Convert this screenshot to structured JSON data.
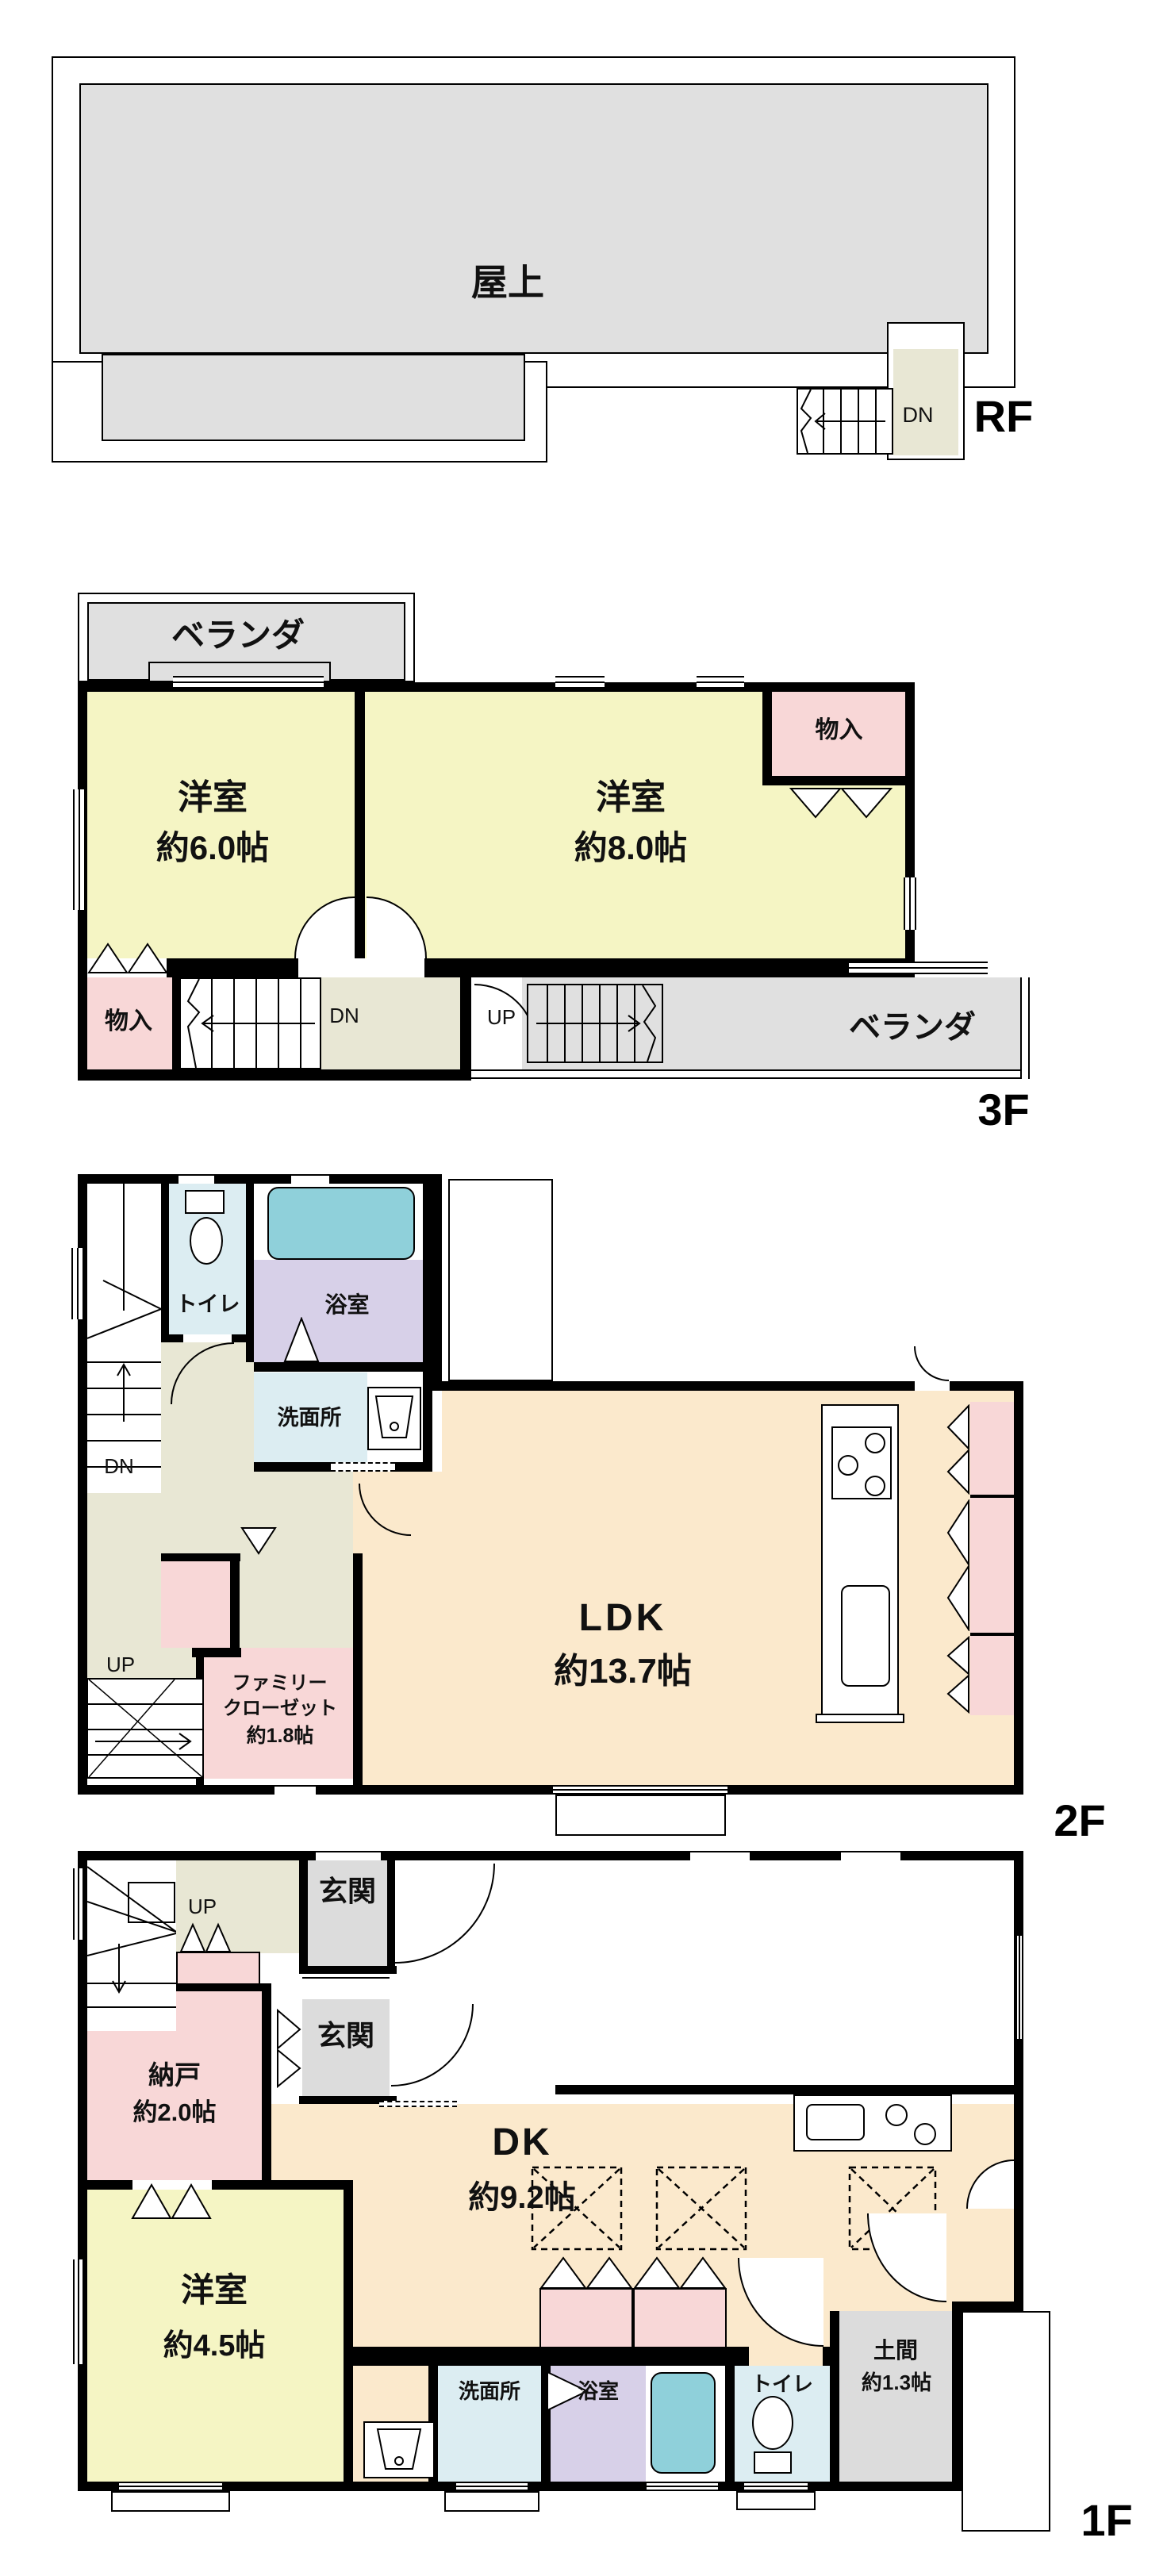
{
  "title": "間取り図",
  "colors": {
    "room_yellow": "#f5f5c4",
    "closet_pink": "#f8d7d7",
    "ldk_cream": "#fbe9cc",
    "wet_blue": "#dcedf2",
    "bath_purple": "#d7d0e8",
    "tub_teal": "#8fd0da",
    "veranda_gray": "#e0e0e0",
    "hall_beige": "#e8e7d4",
    "wall_black": "#000000"
  },
  "floors": {
    "rf": {
      "label": "RF",
      "rooftop": "屋上",
      "dn": "DN"
    },
    "f3": {
      "label": "3F",
      "veranda_top": "ベランダ",
      "veranda_bottom": "ベランダ",
      "room_a_name": "洋室",
      "room_a_size": "約6.0帖",
      "room_b_name": "洋室",
      "room_b_size": "約8.0帖",
      "closet_top": "物入",
      "closet_bottom": "物入",
      "dn": "DN",
      "up": "UP"
    },
    "f2": {
      "label": "2F",
      "toilet": "トイレ",
      "bath": "浴室",
      "washroom": "洗面所",
      "dn": "DN",
      "up": "UP",
      "ldk_name": "LDK",
      "ldk_size": "約13.7帖",
      "family_closet_line1": "ファミリー",
      "family_closet_line2": "クローゼット",
      "family_closet_size": "約1.8帖"
    },
    "f1": {
      "label": "1F",
      "up": "UP",
      "entrance_upper": "玄関",
      "entrance_lower": "玄関",
      "storeroom_name": "納戸",
      "storeroom_size": "約2.0帖",
      "dk_name": "DK",
      "dk_size": "約9.2帖",
      "room_name": "洋室",
      "room_size": "約4.5帖",
      "washroom": "洗面所",
      "bath": "浴室",
      "toilet": "トイレ",
      "doma_name": "土間",
      "doma_size": "約1.3帖"
    }
  }
}
